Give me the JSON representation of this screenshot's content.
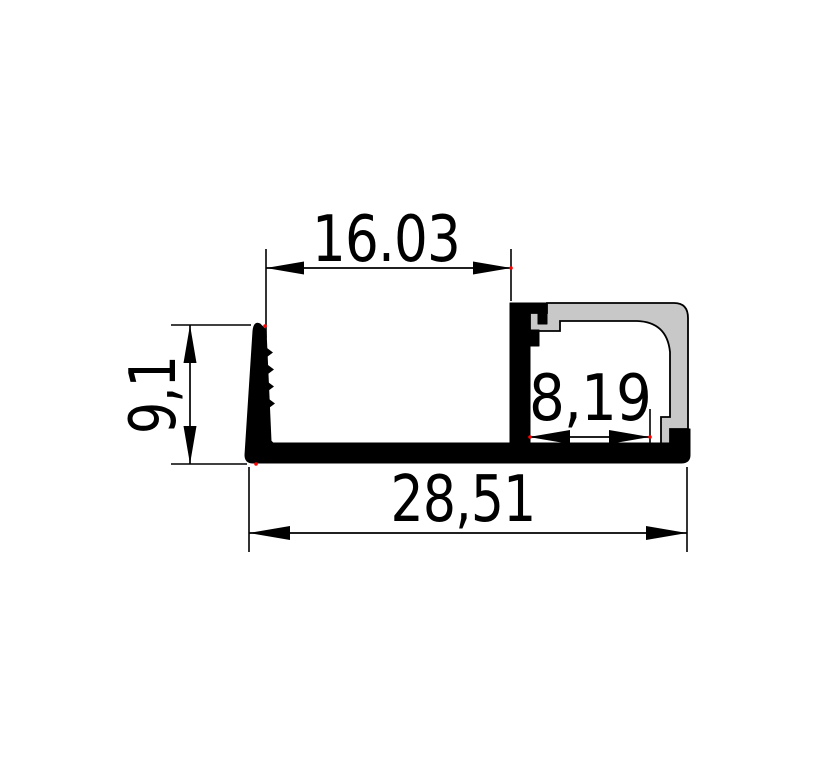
{
  "drawing": {
    "type": "technical-drawing",
    "subject": "aluminum-led-profile-cross-section",
    "background_color": "#ffffff",
    "outline_color": "#000000",
    "profile_fill": "#000000",
    "cover_fill": "#c7c8c7",
    "endpoint_marker_color": "#ff0000",
    "dimensions": {
      "top_width": {
        "label": "16.03",
        "orientation": "horizontal"
      },
      "left_height": {
        "label": "9,1",
        "orientation": "vertical"
      },
      "inner_width": {
        "label": "8,19",
        "orientation": "horizontal"
      },
      "overall_width": {
        "label": "28,51",
        "orientation": "horizontal"
      }
    }
  }
}
